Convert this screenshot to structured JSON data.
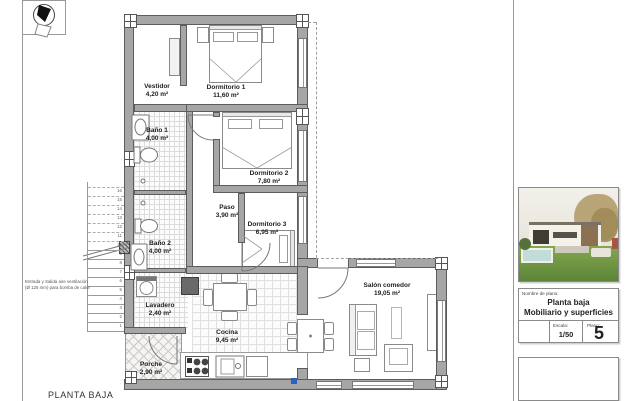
{
  "sheet": {
    "footer_title": "PLANTA BAJA"
  },
  "rooms": [
    {
      "name": "Vestidor",
      "area": "4,20 m²"
    },
    {
      "name": "Dormitorio 1",
      "area": "11,60 m²"
    },
    {
      "name": "Baño 1",
      "area": "4,00 m²"
    },
    {
      "name": "Dormitorio 2",
      "area": "7,80 m²"
    },
    {
      "name": "Paso",
      "area": "3,90 m²"
    },
    {
      "name": "Dormitorio 3",
      "area": "6,95 m²"
    },
    {
      "name": "Baño 2",
      "area": "4,00 m²"
    },
    {
      "name": "Lavadero",
      "area": "2,40 m²"
    },
    {
      "name": "Cocina",
      "area": "9,45 m²"
    },
    {
      "name": "Porche",
      "area": "2,90 m²"
    },
    {
      "name": "Salón comedor",
      "area": "19,05 m²"
    }
  ],
  "notes": {
    "vent_line1": "Entrada y Salida aire ventilación",
    "vent_line2": "(Ø 125 mm) para bomba de calor"
  },
  "stairs": {
    "steps": [
      "1",
      "2",
      "3",
      "4",
      "5",
      "6",
      "7",
      "8",
      "9",
      "10",
      "11",
      "12",
      "13",
      "14",
      "15",
      "16"
    ]
  },
  "title_block": {
    "name_label": "Nombre de plano:",
    "plan_name_line1": "Planta baja",
    "plan_name_line2": "Mobiliario y superficies",
    "scale_label": "Escala:",
    "scale_value": "1/50",
    "number_label": "Plano:",
    "number_value": "5"
  },
  "icons": {
    "north": "north-arrow-icon"
  },
  "colors": {
    "wall_gray": "#a6a6a6",
    "symbol_blue": "#2f5fc0",
    "lawn_green": "#6f9c45",
    "pool_blue": "#c2dcd9"
  }
}
